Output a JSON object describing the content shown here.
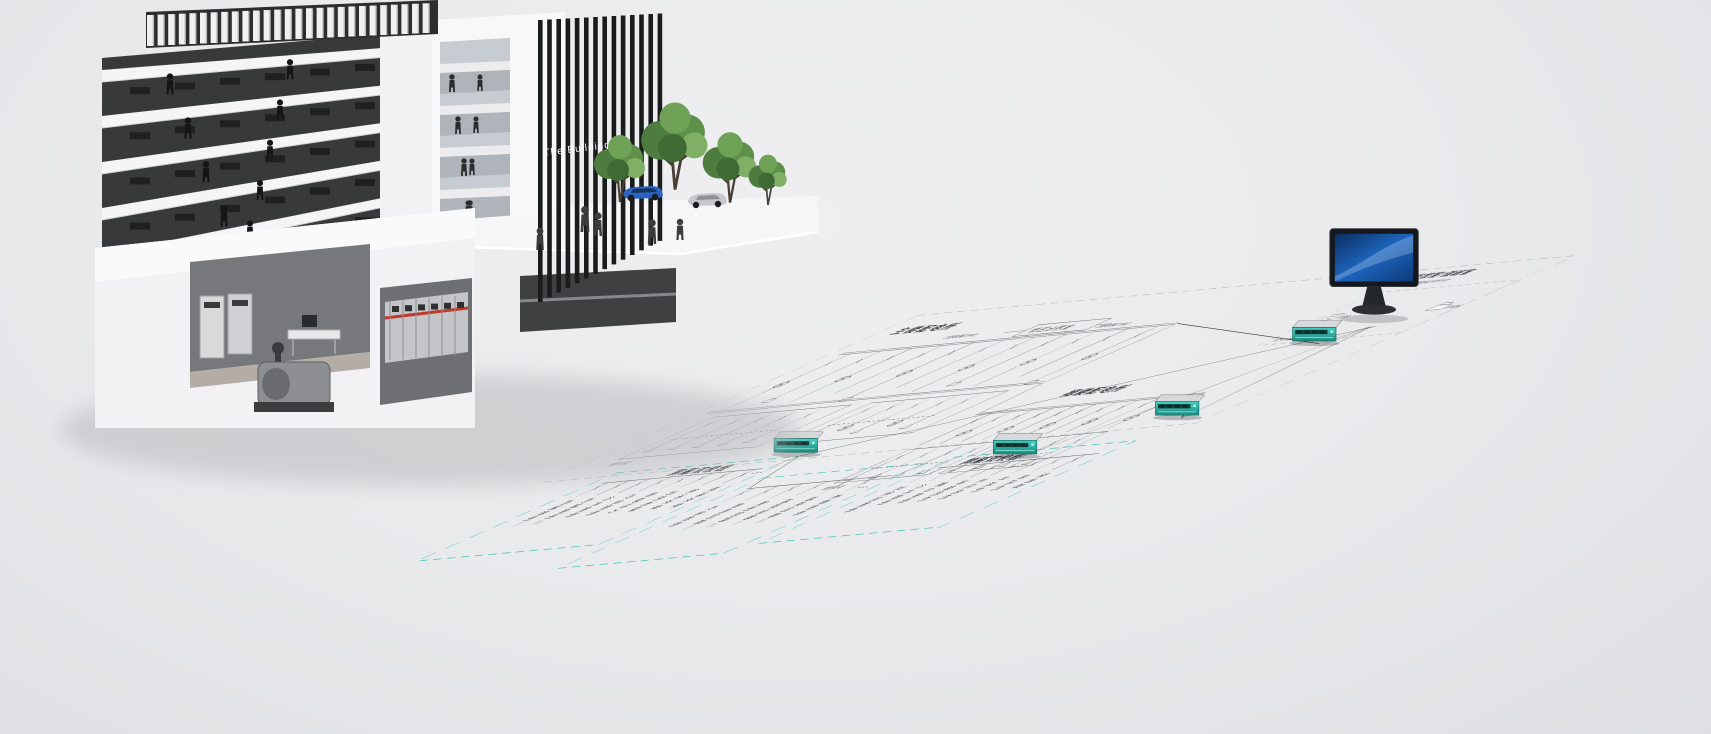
{
  "building": {
    "sign_label": "The Building"
  },
  "network": {
    "monitor_room_title": "监控室/值班室",
    "monitor_room_subtitle": "CloudView 网络电力监控系统",
    "ups_label": "UPS",
    "printer_label": "打印机",
    "protocol_label": "TCP/IP网络协议"
  },
  "substations": {
    "main_title": "主楼配电所",
    "lv_room_label": "低压分界室",
    "feed_left_label": "1路电源(10kV)",
    "feed_right_label": "2路电源(10kV)",
    "fire_load_label": "消防负荷",
    "podium_title": "裙楼配电所"
  },
  "bus_labels": {
    "shielded_twisted_pair": "屏蔽双绞线",
    "ellipsis": "···"
  },
  "floor_boxes": [
    {
      "id": "floor-box-1",
      "circuits": [
        "商铺照明一",
        "商铺照明二",
        "公共照明",
        "应急照明",
        "客梯动力",
        "消防电梯",
        "生活水泵",
        "喷淋水泵"
      ]
    },
    {
      "id": "floor-box-2",
      "circuits": [
        "应急照明",
        "照明回路一",
        "照明回路二",
        "插座回路一",
        "插座回路二",
        "走廊照明"
      ]
    },
    {
      "id": "floor-box-3",
      "circuits": [
        "卫生间照明",
        "公共照明",
        "露台照明",
        "排烟风机",
        "正压风机",
        "补风机",
        "新风机",
        "空调器"
      ]
    }
  ],
  "colors": {
    "accent_teal": "#3fc1b5",
    "device_teal": "#2ab3a5",
    "screen_blue": "#1e66c0",
    "line": "#4c4d50"
  }
}
